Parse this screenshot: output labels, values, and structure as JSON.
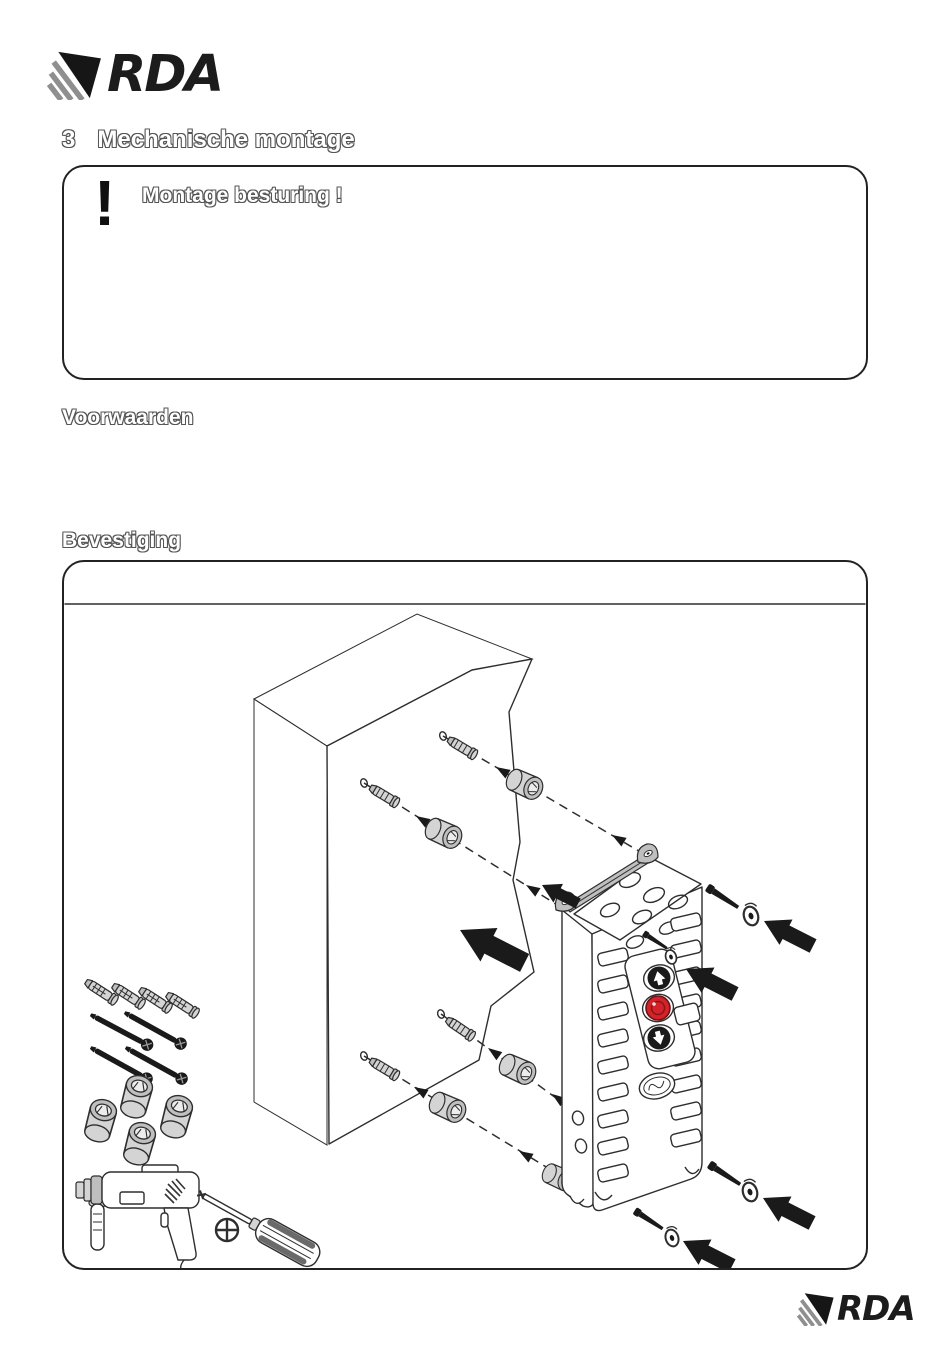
{
  "logos": {
    "header": {
      "text": "RDA"
    },
    "footer": {
      "text": "RDA"
    }
  },
  "heading": {
    "number": "3",
    "text": "Mechanische montage"
  },
  "warning_box": {
    "icon_glyph": "!",
    "title": "Montage besturing !"
  },
  "sections": {
    "conditions_label": "Voorwaarden",
    "mounting_label": "Bevestiging"
  },
  "colors": {
    "ink": "#1a1a1a",
    "line": "#2e2e2e",
    "hatch": "#4d4d4d",
    "metal_light": "#d4d4d4",
    "metal_mid": "#bfbfbf",
    "button_red": "#d2232a",
    "logo_stripe_gray": "#8f8f8f",
    "outline_text_gray": "#555555"
  }
}
